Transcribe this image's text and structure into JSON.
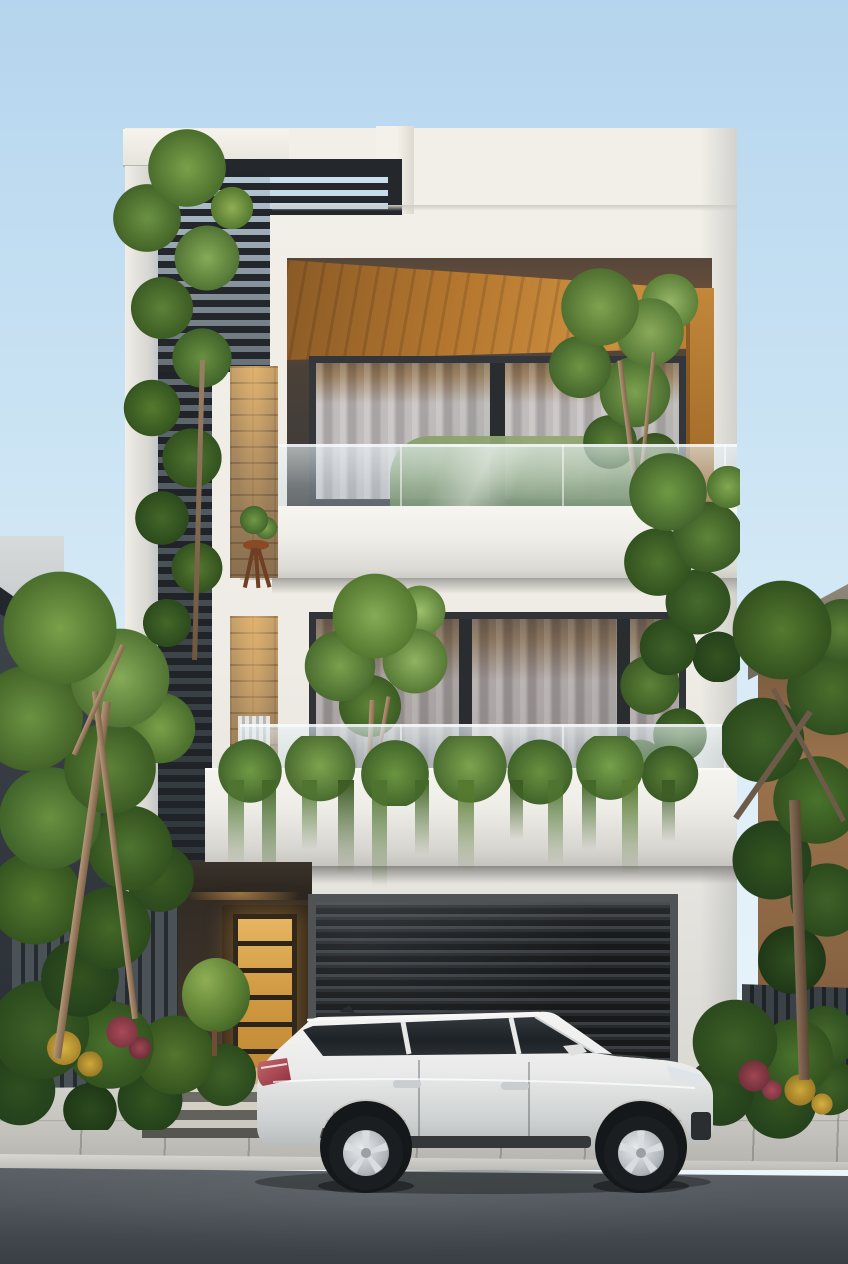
{
  "meta": {
    "title": "Photorealistic rendering of a modern three-storey townhouse at dusk with a white SUV parked on the street",
    "width_px": 848,
    "height_px": 1264
  },
  "scene": {
    "setting": "Street-level front elevation, soft evening light, clear pale-blue sky",
    "objects": [
      {
        "id": "sky",
        "label": "clear sky",
        "color": "#cde5f4"
      },
      {
        "id": "main-house",
        "label": "three-storey modern townhouse, white render facade",
        "color": "#f0ede6"
      },
      {
        "id": "louver-screen",
        "label": "dark horizontal metal louver screen on left tower and roof parapet",
        "color": "#24282c"
      },
      {
        "id": "wood-soffit",
        "label": "timber-clad soffit and side wall of top-floor balcony recess",
        "color": "#c08538"
      },
      {
        "id": "upper-window",
        "label": "top-floor full-width glazing with sheer curtains and warm interior light"
      },
      {
        "id": "middle-window",
        "label": "middle-floor sliding glazing with sheer curtains"
      },
      {
        "id": "glass-balustrades",
        "label": "frameless glass balcony balustrades on both balconies"
      },
      {
        "id": "balcony-hedge",
        "label": "clipped hedge behind upper balcony glass"
      },
      {
        "id": "balcony-trees",
        "label": "small ornamental trees planted on both balconies"
      },
      {
        "id": "hanging-vines",
        "label": "trailing vines cascading over middle balcony parapet and right building corner"
      },
      {
        "id": "brick-niche",
        "label": "tall brick-lined wall niches with plant stand, white pipe sculpture and chair",
        "color": "#a8885f"
      },
      {
        "id": "entrance-door",
        "label": "timber entrance door with six amber glowing horizontal panels",
        "color": "#dda44c"
      },
      {
        "id": "entrance-steps",
        "label": "concrete entry steps with warm light spill"
      },
      {
        "id": "garage-door",
        "label": "dark ribbed roller garage door",
        "color": "#1d2022"
      },
      {
        "id": "suv",
        "label": "white mid-size SUV parked facing right on the street",
        "color": "#eeefee"
      },
      {
        "id": "left-neighbor",
        "label": "dark grey neighbouring building with sloped roof edge, left"
      },
      {
        "id": "right-neighbor",
        "label": "tan neighbouring building with grey stone flat roof, right",
        "color": "#96714d"
      },
      {
        "id": "street-trees",
        "label": "large green trees flanking the house and a slender tree against the louver tower"
      },
      {
        "id": "flower-beds",
        "label": "planting beds with green shrubs, yellow and crimson flowers and a round topiary"
      },
      {
        "id": "slat-fences",
        "label": "vertical dark slat fences at both property edges",
        "color": "#2a3034"
      },
      {
        "id": "sidewalk",
        "label": "light paved sidewalk with expansion joints",
        "color": "#c8c7c1"
      },
      {
        "id": "road",
        "label": "grey asphalt road in foreground",
        "color": "#565c61"
      }
    ]
  },
  "palette": {
    "sky_top": "#b5d5ee",
    "sky_mid": "#cde5f4",
    "facade": "#f0ede6",
    "louver_dark": "#24282c",
    "wood": "#c2873a",
    "wood_dark": "#8a5a26",
    "frame_dark": "#33363a",
    "curtain": "#b5b1b2",
    "interior_warm": "#6e5233",
    "brick": "#a8885f",
    "door_amber": "#d09a42",
    "door_frame": "#2e2519",
    "garage_dark": "#17191b",
    "garage_rib": "#3a3e42",
    "green_light": "#8fae54",
    "green_mid": "#55792f",
    "green_dark": "#33521f",
    "flower_red": "#a04a55",
    "flower_yellow": "#cfa93a",
    "street": "#5d6368",
    "street_dark": "#383e43",
    "sidewalk": "#c8c7c1",
    "fence_dark": "#262b2f",
    "fence_slat": "#4b5257",
    "neighbor_left_roof": "#22272b",
    "neighbor_right_wall": "#96714d",
    "car_body": "#eeefee"
  }
}
